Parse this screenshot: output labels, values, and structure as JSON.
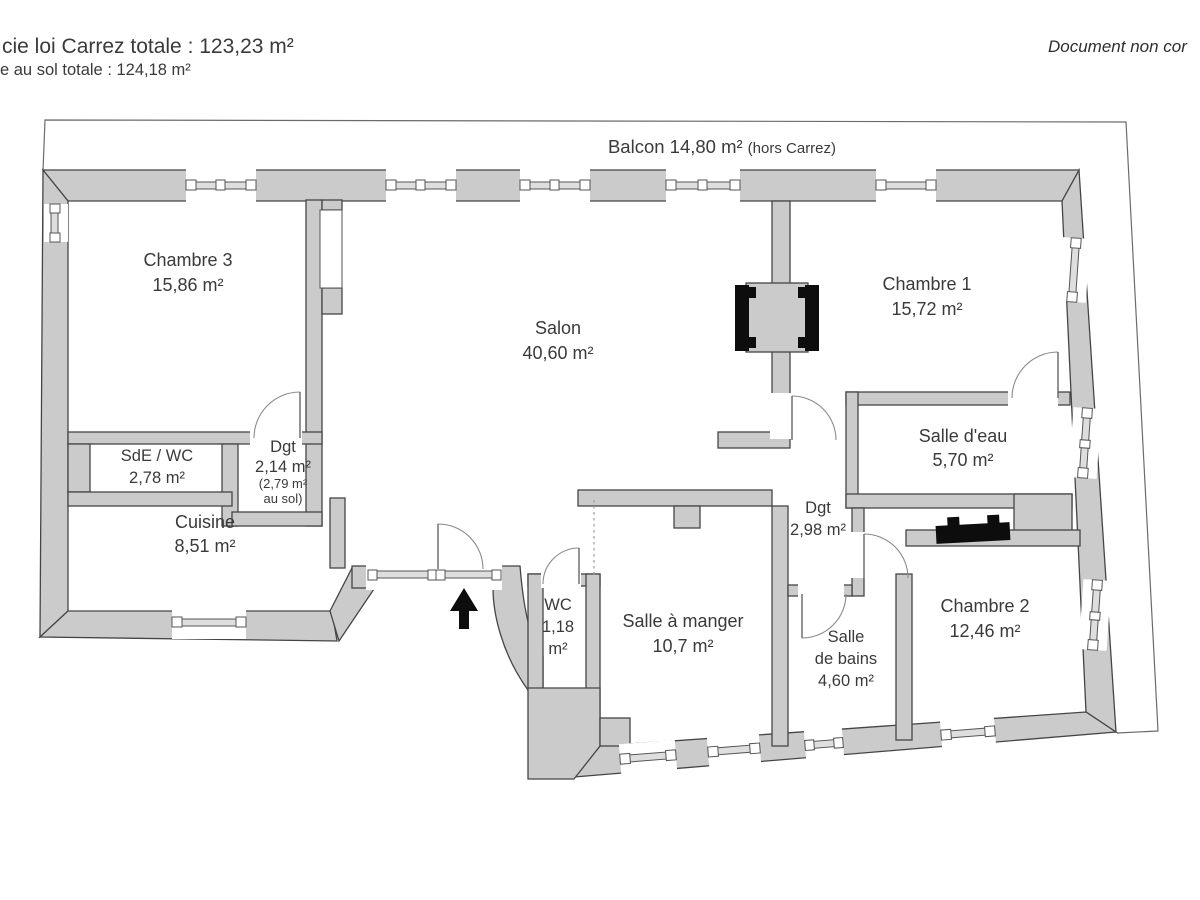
{
  "header": {
    "carrez_total": "cie loi Carrez totale : 123,23 m²",
    "floor_total": "e au sol totale : 124,18 m²",
    "disclaimer": "Document non cor"
  },
  "balcony": {
    "label": "Balcon 14,80 m²",
    "suffix": "(hors Carrez)"
  },
  "rooms": {
    "chambre3": {
      "name": "Chambre 3",
      "area": "15,86 m²"
    },
    "salon": {
      "name": "Salon",
      "area": "40,60 m²"
    },
    "chambre1": {
      "name": "Chambre 1",
      "area": "15,72 m²"
    },
    "sde_wc": {
      "name": "SdE / WC",
      "area": "2,78 m²"
    },
    "dgt1": {
      "name": "Dgt",
      "area": "2,14 m²",
      "floor_note_1": "(2,79 m²",
      "floor_note_2": "au sol)"
    },
    "cuisine": {
      "name": "Cuisine",
      "area": "8,51 m²"
    },
    "salle_eau": {
      "name": "Salle d'eau",
      "area": "5,70 m²"
    },
    "dgt2": {
      "name": "Dgt",
      "area": "2,98 m²"
    },
    "wc": {
      "name": "WC",
      "area_line1": "1,18",
      "area_line2": "m²"
    },
    "salle_a_manger": {
      "name": "Salle à manger",
      "area": "10,7 m²"
    },
    "salle_de_bains": {
      "name_line1": "Salle",
      "name_line2": "de bains",
      "area": "4,60 m²"
    },
    "chambre2": {
      "name": "Chambre 2",
      "area": "12,46 m²"
    }
  },
  "colors": {
    "wall_fill": "#cbcbcb",
    "wall_stroke": "#454545",
    "text": "#3a3a3a",
    "feature_black": "#0d0d0d"
  }
}
